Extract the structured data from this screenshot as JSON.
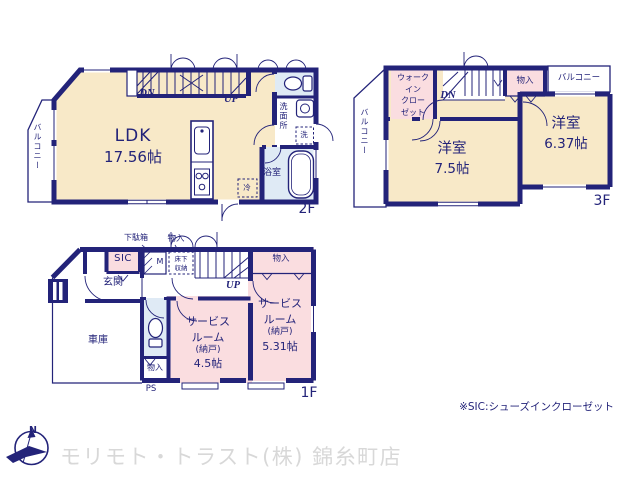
{
  "colors": {
    "wall_navy": "#232379",
    "room_cream": "#f8e9c8",
    "room_pink": "#fadde0",
    "room_blue": "#dfeaf5",
    "watermark_gray": "#d8d8d8"
  },
  "f2": {
    "label": "2F",
    "balcony": "バルコニー",
    "ldk_name": "LDK",
    "ldk_area": "17.56帖",
    "dn": "DN",
    "up": "UP",
    "washroom": "洗面所",
    "washer": "洗",
    "bath": "浴室",
    "fridge": "冷"
  },
  "f3": {
    "label": "3F",
    "balcony_left": "バルコニー",
    "balcony_top": "バルコニー",
    "wic_l1": "ウォーク",
    "wic_l2": "イン",
    "wic_l3": "クロー",
    "wic_l4": "ゼット",
    "dn": "DN",
    "closet": "物入",
    "room_main_name": "洋室",
    "room_main_area": "7.5帖",
    "room_sub_name": "洋室",
    "room_sub_area": "6.37帖"
  },
  "f1": {
    "label": "1F",
    "shoe_cabinet": "下駄箱",
    "closet_top": "物入",
    "sic": "SIC",
    "meter": "M",
    "underfloor_l1": "床下",
    "underfloor_l2": "収納",
    "up": "UP",
    "closet_right": "物入",
    "entrance": "玄関",
    "garage": "車庫",
    "service_a_l1": "サービス",
    "service_a_l2": "ルーム",
    "service_a_l3": "(納戸)",
    "service_a_l4": "4.5帖",
    "service_b_l1": "サービス",
    "service_b_l2": "ルーム",
    "service_b_l3": "(納戸)",
    "service_b_l4": "5.31帖",
    "closet_bottom": "物入",
    "ps": "PS"
  },
  "note": "※SIC:シューズインクローゼット",
  "footer": {
    "compass_n": "N",
    "company": "モリモト・トラスト(株) 錦糸町店"
  }
}
